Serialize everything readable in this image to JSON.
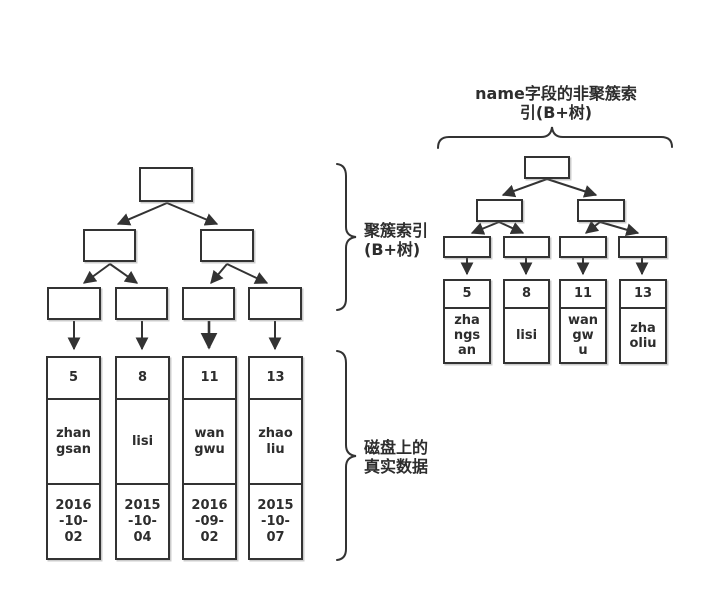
{
  "colors": {
    "line": "#333333",
    "text": "#2d2d2d",
    "background": "#ffffff"
  },
  "left_tree": {
    "brace_label": "聚簇索引\n(B+树)",
    "disk_label": "磁盘上的\n真实数据",
    "columns": [
      {
        "id": "5",
        "name": "zhan\ngsan",
        "date": "2016\n-10-\n02"
      },
      {
        "id": "8",
        "name": "lisi",
        "date": "2015\n-10-\n04"
      },
      {
        "id": "11",
        "name": "wan\ngwu",
        "date": "2016\n-09-\n02"
      },
      {
        "id": "13",
        "name": "zhao\nliu",
        "date": "2015\n-10-\n07"
      }
    ]
  },
  "right_tree": {
    "title": "name字段的非聚簇索\n引(B+树)",
    "columns": [
      {
        "id": "5",
        "name": "zha\nngs\nan"
      },
      {
        "id": "8",
        "name": "lisi"
      },
      {
        "id": "11",
        "name": "wan\ngw\nu"
      },
      {
        "id": "13",
        "name": "zha\noliu"
      }
    ]
  }
}
